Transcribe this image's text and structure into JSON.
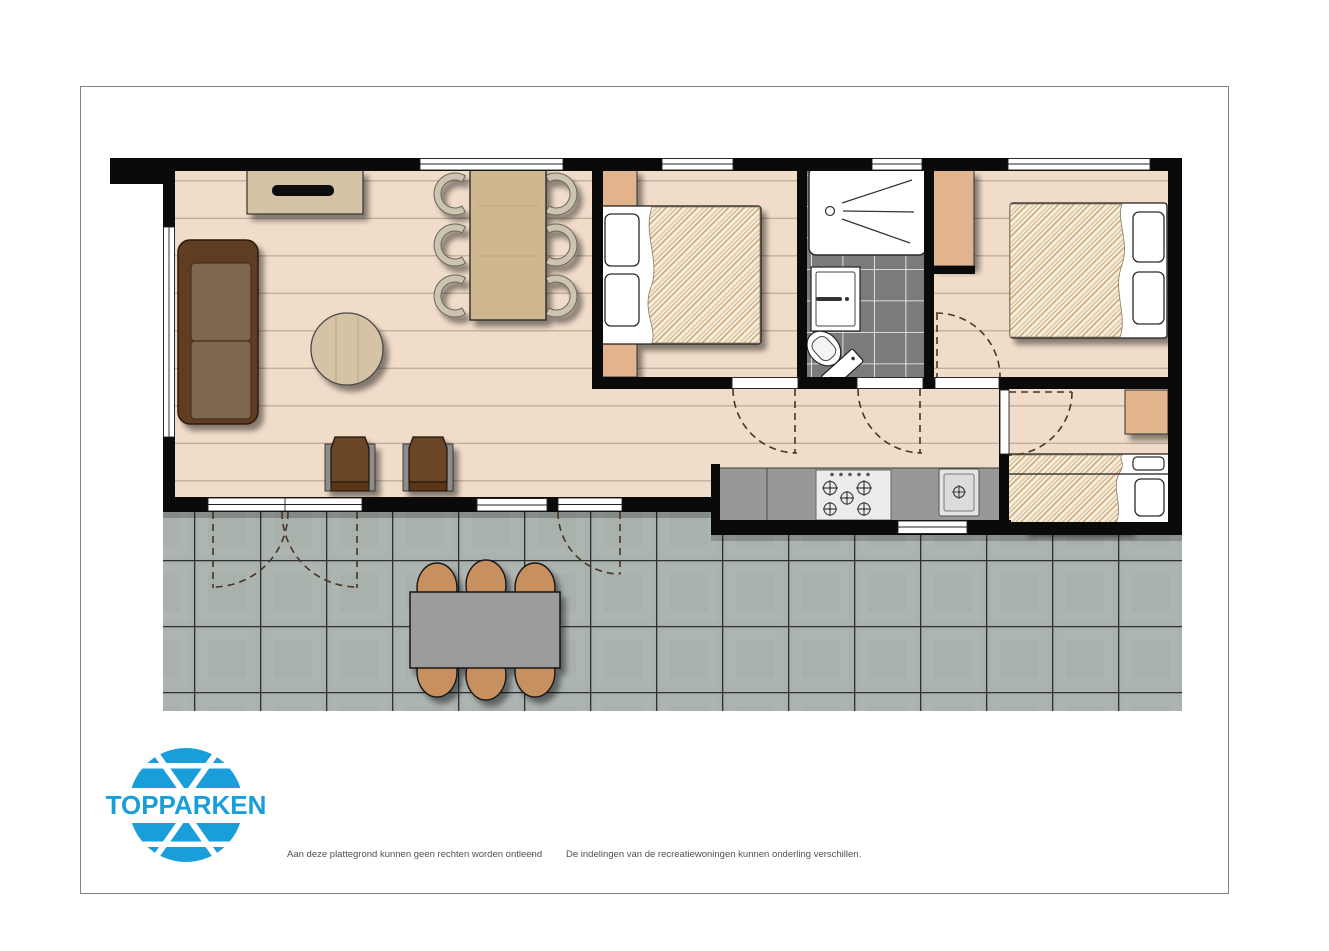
{
  "logo": {
    "text": "TOPPARKEN",
    "color": "#1a9ed9"
  },
  "footer": {
    "left_text": "Aan deze plattegrond kunnen geen rechten worden ontleend",
    "separator": "-",
    "right_text": "De indelingen van de recreatiewoningen kunnen onderling verschillen."
  },
  "floor_plan": {
    "type": "holiday-home top-down floor plan",
    "colors": {
      "wall": "#0a0a0a",
      "wood_floor": "#f1dcc9",
      "plank_line": "#b7a391",
      "closet_tan": "#e2b48e",
      "terrace_tile": "#a9b2af",
      "terrace_grout": "#2e2e2e",
      "bathroom_tile": "#7b7b7b",
      "kitchen_counter": "#989898",
      "sofa_frame": "#5f3d21",
      "sofa_cushion": "#7d6750",
      "armchair": "#6b4425",
      "wood_furniture": "#d6c3a5",
      "duvet_hatch": "#cfa060",
      "stool": "#c8905f",
      "terrace_table": "#9c9c9c",
      "window_frame": "#ffffff"
    },
    "rooms": [
      {
        "name": "living-dining-room",
        "furniture": [
          "sofa",
          "coffee-table",
          "tv-sideboard",
          "dining-table",
          "six-dining-chairs",
          "two-armchairs"
        ]
      },
      {
        "name": "bedroom-1",
        "furniture": [
          "double-bed",
          "two-bedside-cabinets"
        ]
      },
      {
        "name": "bathroom",
        "furniture": [
          "shower",
          "washbasin",
          "toilet"
        ]
      },
      {
        "name": "bedroom-2",
        "furniture": [
          "double-bed",
          "wardrobe"
        ]
      },
      {
        "name": "bedroom-3",
        "furniture": [
          "bunk-bed",
          "wardrobe"
        ]
      },
      {
        "name": "kitchen",
        "furniture": [
          "counter",
          "five-burner-hob",
          "sink"
        ]
      },
      {
        "name": "terrace",
        "furniture": [
          "picnic-table",
          "six-stools"
        ]
      }
    ]
  }
}
